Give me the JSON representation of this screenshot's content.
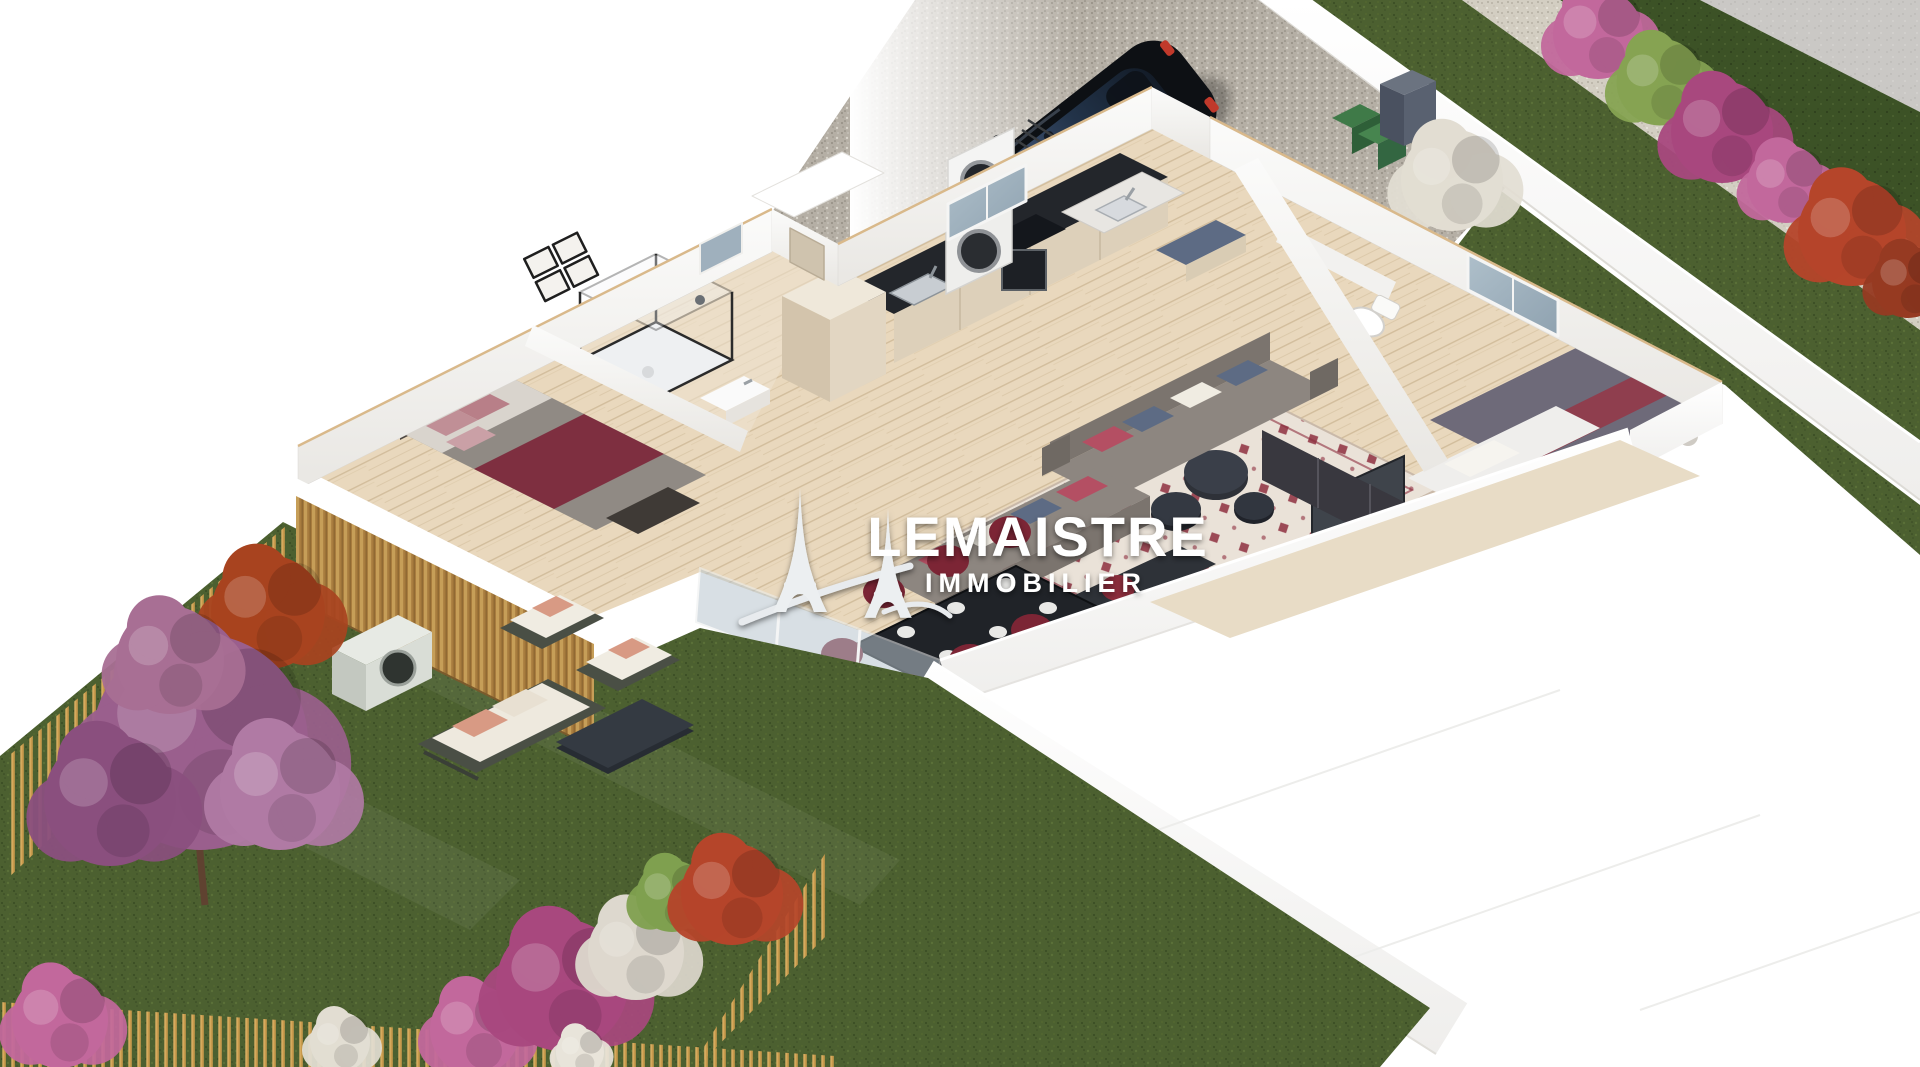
{
  "watermark": {
    "brand": "LEMAISTRE",
    "tagline": "IMMOBILIER",
    "logo": "eiffel-tower-pair-icon",
    "text_color": "#ffffff"
  },
  "palette": {
    "background": "#ffffff",
    "gravel_drive": "#b5afa5",
    "gravel_path": "#d3cec2",
    "concrete": "#cac8c5",
    "grass": "#4c6030",
    "grass_dark": "#3c5226",
    "wood_floor": "#e9d8bd",
    "wall_white": "#f6f5f3",
    "wall_cut_edge": "#d9b98b",
    "wood_slat": "#a87c3e",
    "fence_gold": "#c89a4c",
    "counter_black": "#23262b",
    "cabinet_beige": "#ddd0ba",
    "sofa_gray": "#8d8680",
    "bed_gray": "#908a84",
    "bed_purple": "#6e6a79",
    "burgundy": "#7e2f40",
    "dining_chair": "#7c2535",
    "rug_cream": "#eae2d8",
    "rug_motif": "#8e2f3f",
    "car_black": "#0d1014",
    "car_glass": "#3a4f6e",
    "glass_blue": "#aebfca",
    "bin_green": "#3f7a48",
    "utility_gray": "#596170",
    "bush_magenta": "#a8487e",
    "bush_purple_tree": "#9a5f8d",
    "bush_red": "#b5452a",
    "bush_pink": "#c2689c",
    "bush_green": "#86a352",
    "bush_white": "#e2ddd2",
    "pillow_red": "#b44f63",
    "pillow_blue": "#5d6b84",
    "cushion_white": "#f0ece2"
  }
}
